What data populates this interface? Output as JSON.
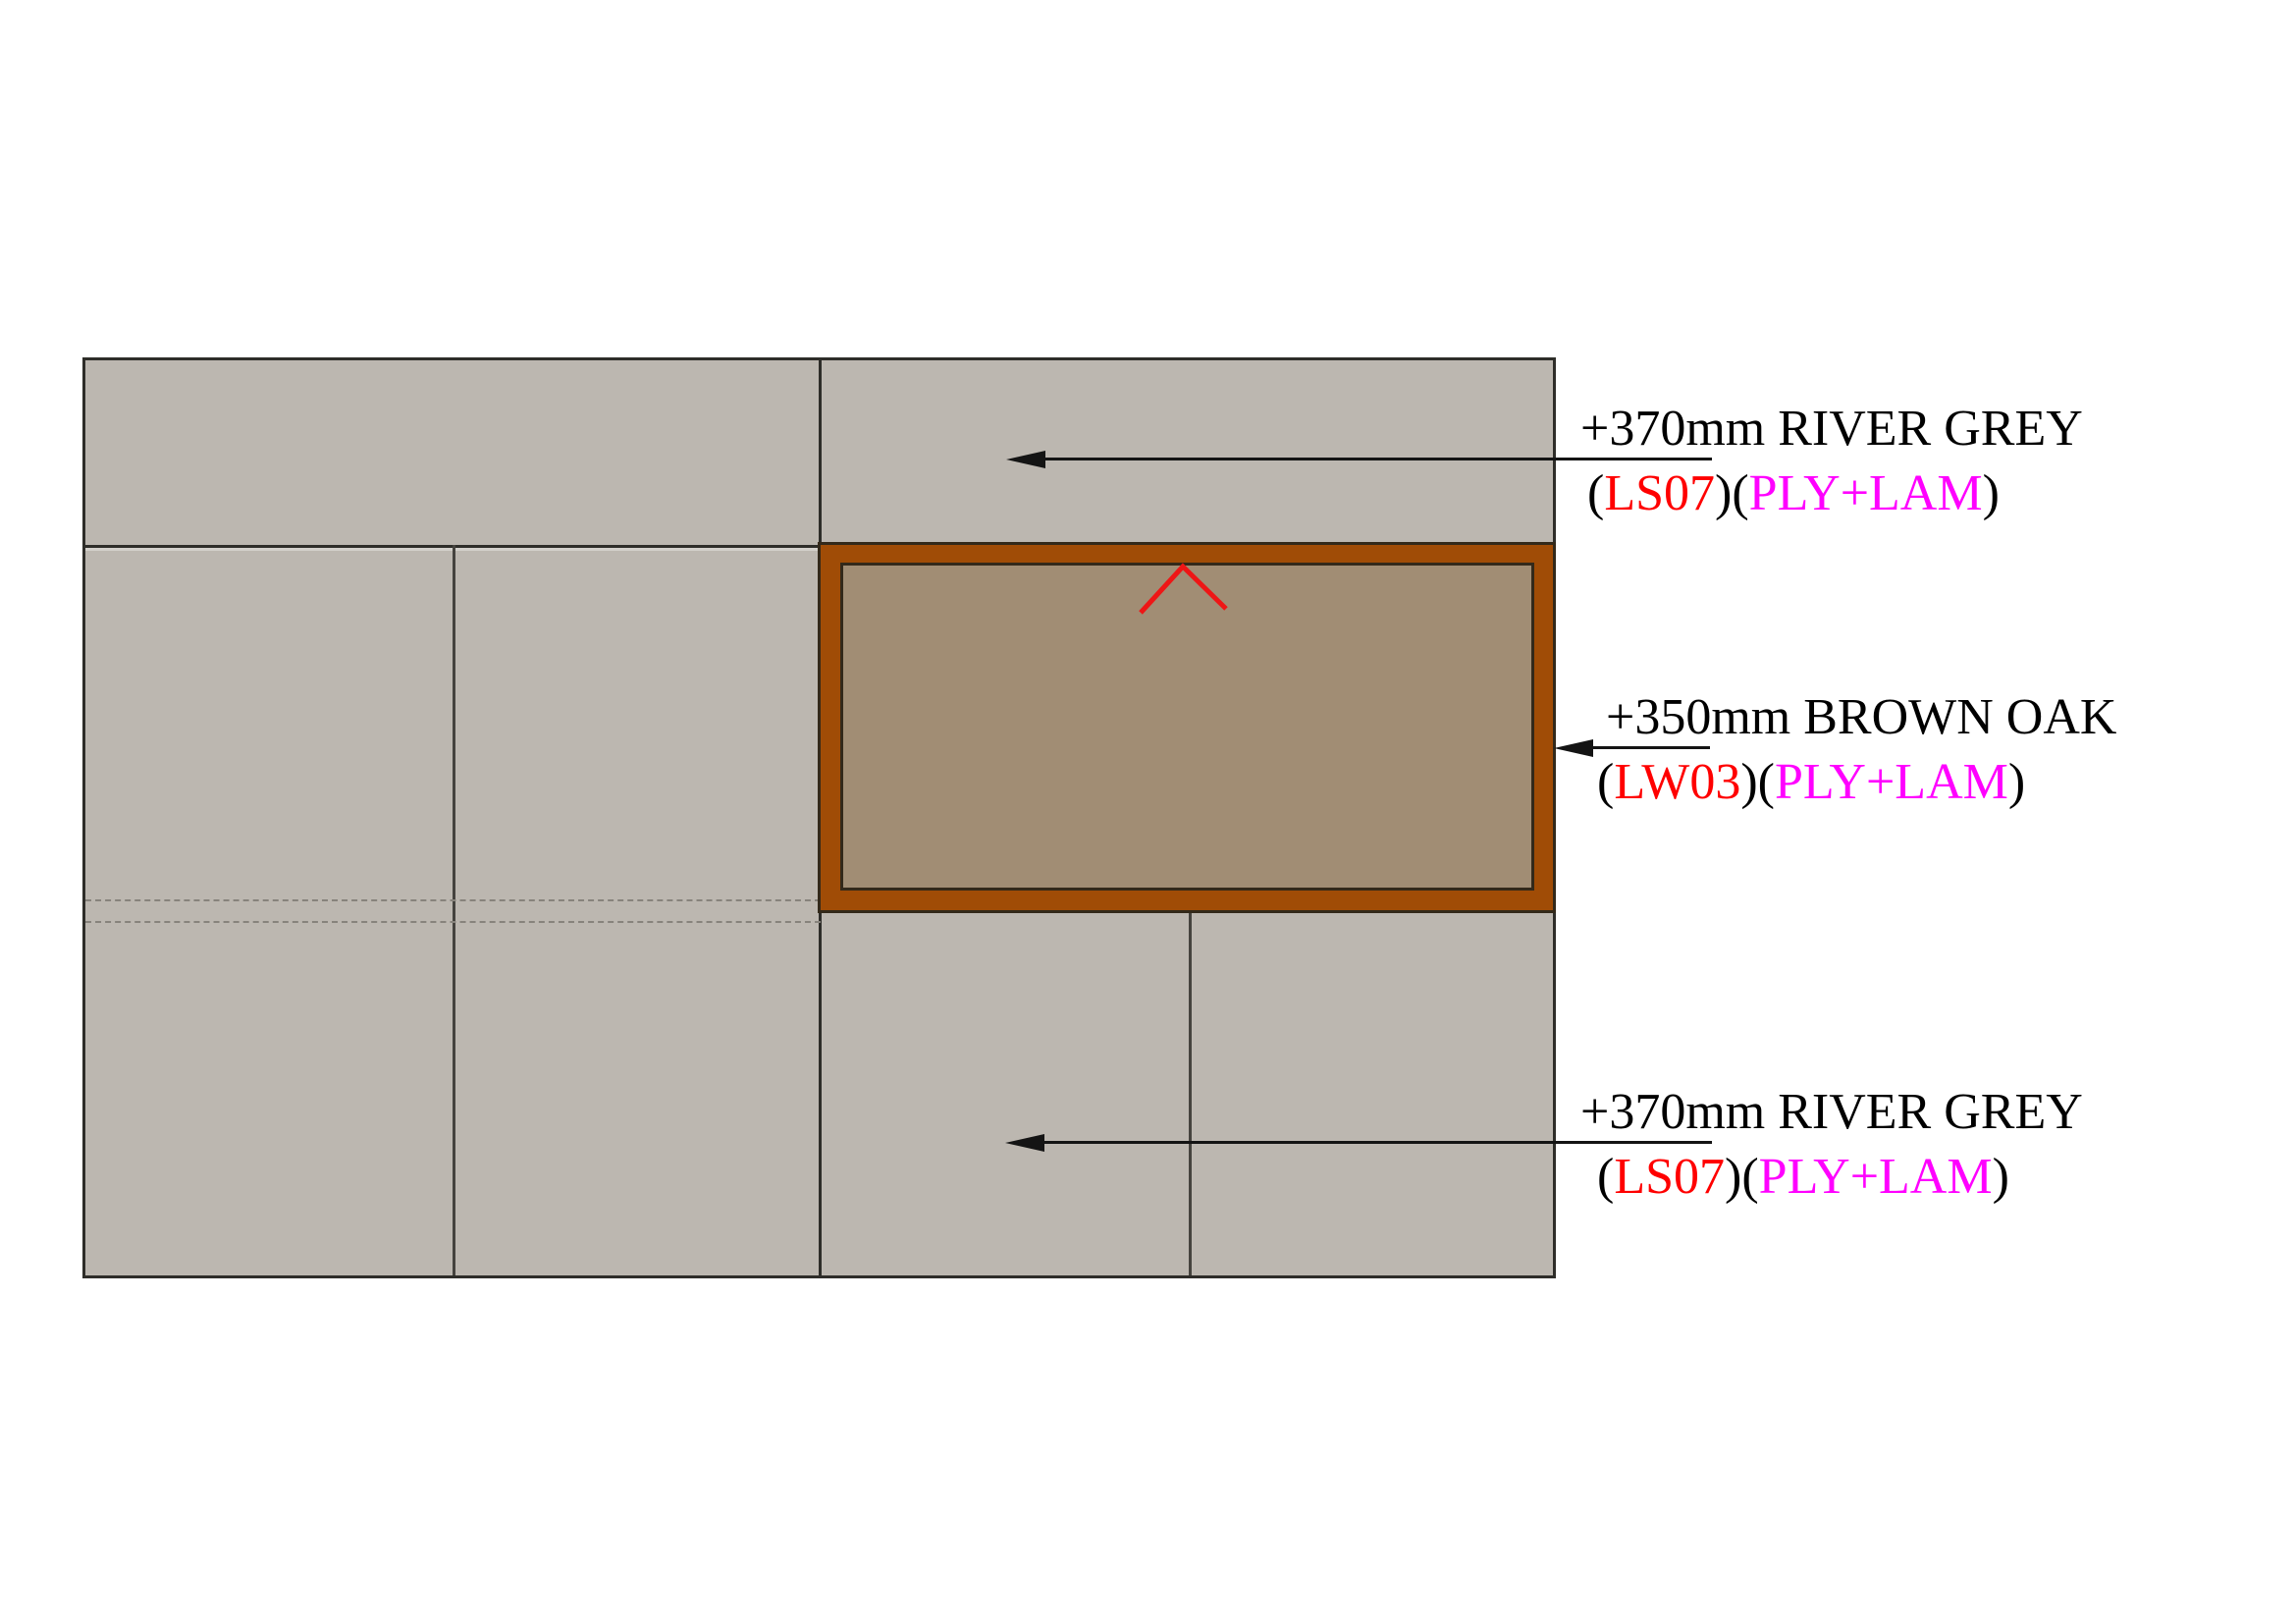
{
  "colors": {
    "page_bg": "#ffffff",
    "panel_grey": "#bcb7b0",
    "outline": "#2e2d29",
    "seam": "#45433e",
    "dashed": "#87837c",
    "brown_frame": "#a04c06",
    "brown_inner": "#a18d74",
    "frame_outline": "#33291a",
    "chevron_red": "#ee1616",
    "leader": "#141414",
    "text": "#000000",
    "code_red": "#ff0000",
    "material_magenta": "#ff00ff"
  },
  "annotations": {
    "top": {
      "line1": "+370mm RIVER GREY",
      "open": "(",
      "code": "LS07",
      "mid": ")(",
      "material": "PLY+LAM",
      "close": ")"
    },
    "middle": {
      "line1": "+350mm BROWN OAK",
      "open": "(",
      "code": "LW03",
      "mid": ")(",
      "material": "PLY+LAM",
      "close": ")"
    },
    "bottom": {
      "line1": "+370mm RIVER GREY",
      "open": "(",
      "code": "LS07",
      "mid": ")(",
      "material": "PLY+LAM",
      "close": ")"
    }
  }
}
